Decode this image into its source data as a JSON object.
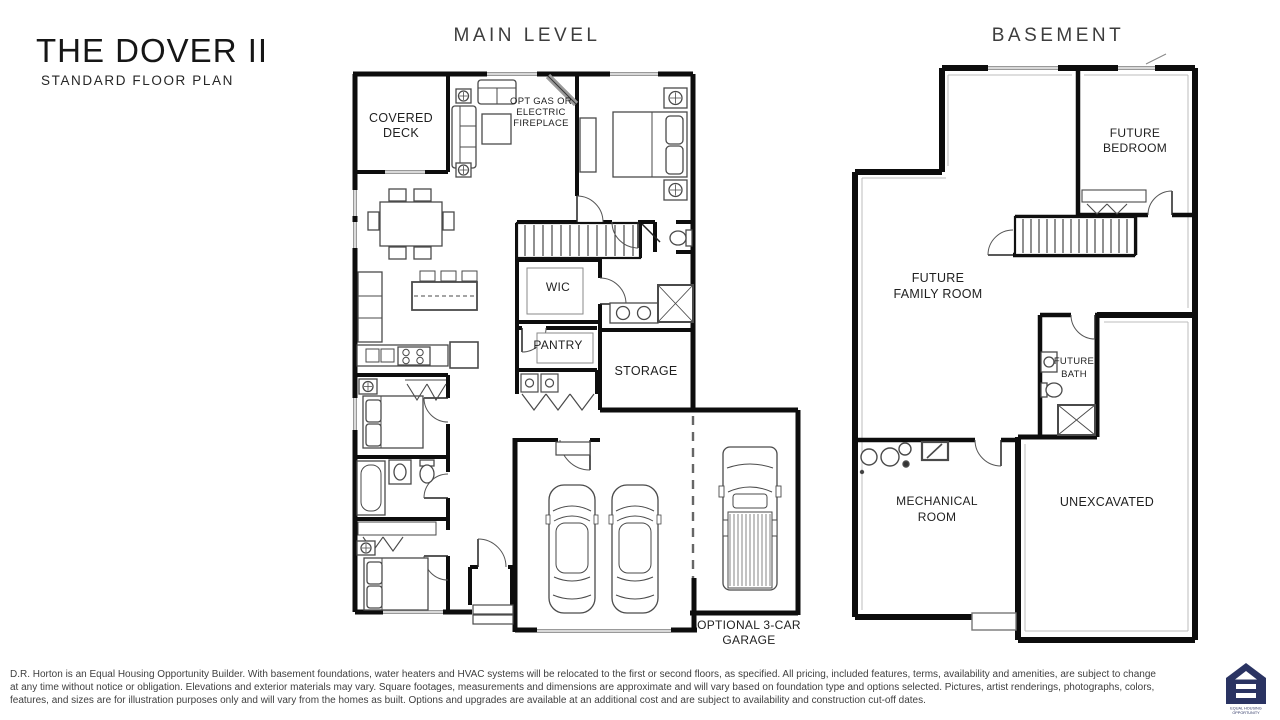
{
  "header": {
    "title": "THE DOVER II",
    "subtitle": "STANDARD FLOOR PLAN"
  },
  "main_level": {
    "heading": "MAIN LEVEL",
    "labels": {
      "covered_deck_line1": "COVERED",
      "covered_deck_line2": "DECK",
      "fireplace_line1": "OPT GAS OR",
      "fireplace_line2": "ELECTRIC",
      "fireplace_line3": "FIREPLACE",
      "wic": "WIC",
      "pantry": "PANTRY",
      "storage": "STORAGE",
      "optional_garage_line1": "OPTIONAL 3-CAR",
      "optional_garage_line2": "GARAGE"
    }
  },
  "basement": {
    "heading": "BASEMENT",
    "labels": {
      "future_bedroom_line1": "FUTURE",
      "future_bedroom_line2": "BEDROOM",
      "future_family_room_line1": "FUTURE",
      "future_family_room_line2": "FAMILY ROOM",
      "future_bath_line1": "FUTURE",
      "future_bath_line2": "BATH",
      "mechanical_room_line1": "MECHANICAL",
      "mechanical_room_line2": "ROOM",
      "unexcavated": "UNEXCAVATED"
    }
  },
  "footer": {
    "disclaimer_line1": "D.R. Horton is an Equal Housing Opportunity Builder. With basement foundations, water heaters and HVAC systems will be relocated to the first or second floors, as specified. All pricing, included features, terms, availability and amenities, are subject to change",
    "disclaimer_line2": "at any time without notice or obligation. Elevations and exterior materials may vary. Square footages, measurements and dimensions are approximate and will vary based on foundation type and options selected. Pictures, artist renderings, photographs, colors,",
    "disclaimer_line3": "features, and sizes are for illustration purposes only and will vary from the homes as built. Options and upgrades are available at an additional cost and are subject to availability and construction cut-off dates.",
    "eho_logo": {
      "line1": "EQUAL HOUSING",
      "line2": "OPPORTUNITY",
      "color": "#2a3362"
    }
  },
  "colors": {
    "wall": "#0d0d0d",
    "furniture": "#4a4a4a",
    "label": "#1f1f1f",
    "heading": "#3d3d3d"
  }
}
